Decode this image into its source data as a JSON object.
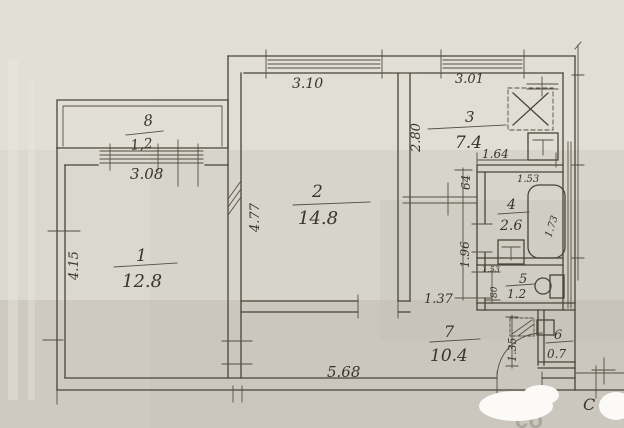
{
  "title": "apartment floor plan scan",
  "colors": {
    "paper": "#d7d4cb",
    "paper_light": "#e9e6df",
    "paper_dark": "#b7b4ab",
    "ink": "#4a4336",
    "whiteout": "#fbfaf6"
  },
  "rooms": {
    "r1": {
      "number": "1",
      "area": "12.8"
    },
    "r2": {
      "number": "2",
      "area": "14.8"
    },
    "r3": {
      "number": "3",
      "area": "7.4"
    },
    "r4": {
      "number": "4",
      "area": "2.6"
    },
    "r5": {
      "number": "5",
      "area": "1.2"
    },
    "r6": {
      "number": "6",
      "area": "0.7"
    },
    "r7": {
      "number": "7",
      "area": "10.4"
    },
    "r8": {
      "number": "8",
      "area": "1,2"
    }
  },
  "dims": {
    "balcony_width": "3.08",
    "room2_window": "3.10",
    "kitchen_window": "3.01",
    "kitchen_depth": "2.80",
    "room1_depth": "4.15",
    "room2_depth": "4.77",
    "bath_block_width": "1.64",
    "kitchen_door": "64",
    "bath_width": "1.53",
    "tub_length": "1.73",
    "wc_width": "1.53",
    "wc_depth": "80",
    "hall_strip": "1.96",
    "hall_width": "1.37",
    "entry_nook": "1.35",
    "corridor_length": "5.68"
  },
  "annotations": {
    "compass": "C",
    "watermark": "co"
  },
  "fixtures": [
    "gas-stove",
    "kitchen-sink",
    "bathtub",
    "washbasin",
    "toilet",
    "wardrobe"
  ]
}
